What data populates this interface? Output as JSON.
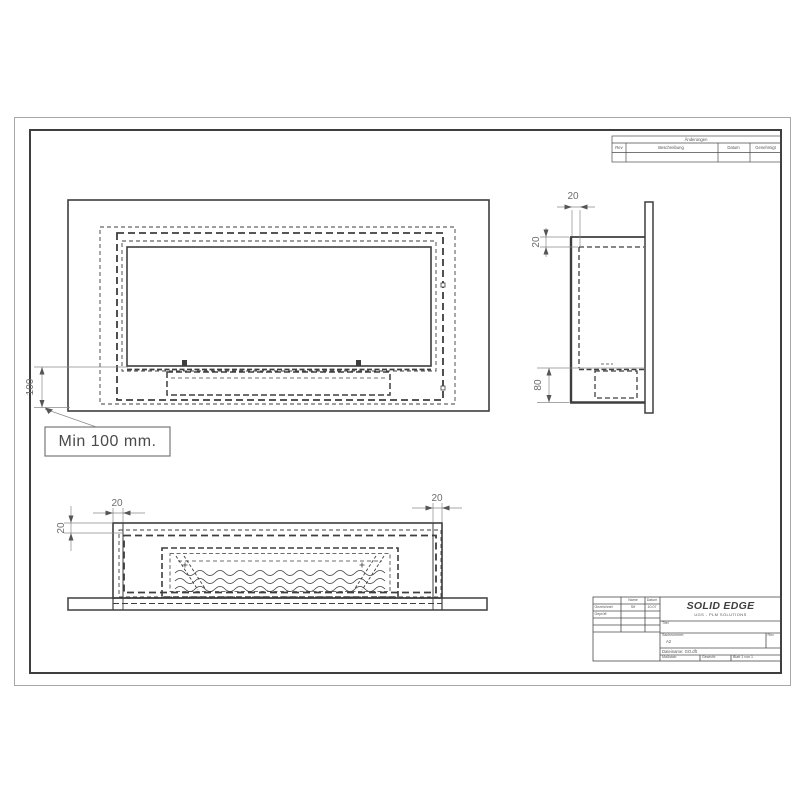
{
  "sheet": {
    "revision_table": {
      "title": "Änderungen",
      "col_rev": "Rev",
      "col_description": "Beschreibung",
      "col_date": "Datum",
      "col_approved": "Genehmigt"
    },
    "title_block": {
      "name_header": "Name",
      "date_header": "Datum",
      "drawn_label": "Gezeichnet",
      "drawn_name": "Stf",
      "drawn_date": "10.07",
      "checked_label": "Geprüft",
      "logo_title": "SOLID EDGE",
      "logo_subtitle": "UGS - PLM SOLUTIONS",
      "title_label": "Titel",
      "docnumber_label": "Sachnummer:",
      "sheet_size": "A2",
      "rev_label": "Rev",
      "filename_row": "Dateiname: GO.dft",
      "scale_label": "Maßstab:",
      "weight_label": "Gewicht:",
      "sheet_label": "Blatt 1 von 1"
    }
  },
  "views": {
    "front": {
      "offset_dim": "100",
      "callout": "Min 100 mm."
    },
    "side": {
      "top_wall_dim": "20",
      "left_gap_dim": "20",
      "burner_zone_dim": "80"
    },
    "bottom": {
      "left_wall_dim": "20",
      "right_wall_dim": "20",
      "side_wall_dim": "20"
    }
  }
}
